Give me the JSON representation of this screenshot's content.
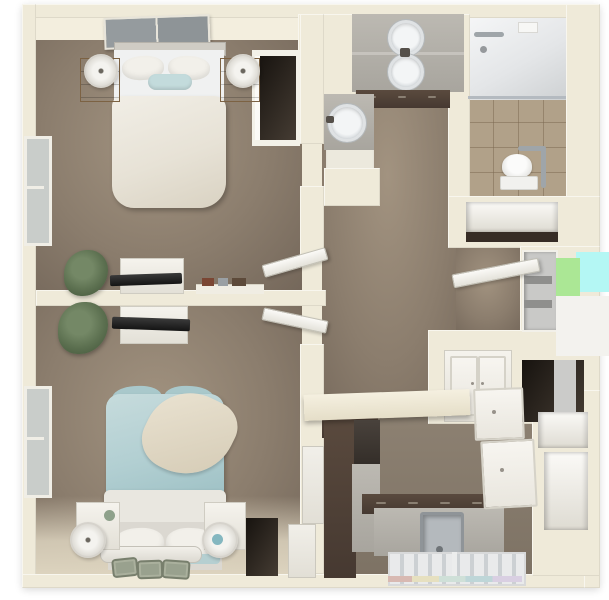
{
  "meta": {
    "description": "Top-down 3D render of a one-floor apartment floor plan",
    "render_style": "3d-dollhouse-view"
  },
  "palette": {
    "wall": "#efead9",
    "wallLight": "#f3eede",
    "carpet": "#8b7d6d",
    "carpetLight": "#a29380",
    "carpetDark": "#74675a",
    "tile": "#b1a189",
    "espresso": "#463931",
    "counter": "#a8a59e",
    "bedTeal": "#b2cfd2",
    "throwCream": "#d4cab4",
    "tvBlack": "#141414",
    "plantGreen": "#5c7050",
    "wood": "#8f7450",
    "glitchCyan": "#b4f7f4",
    "glitchGreen": "#abe795"
  },
  "rooms": [
    {
      "id": "bedroom-1",
      "label": "Bedroom 1",
      "furniture": [
        "wall-art",
        "bed-white",
        "pillows",
        "teal-accent-pillow",
        "nightstand-left",
        "table-lamp-left",
        "nightstand-right",
        "table-lamp-right",
        "window",
        "potted-plant",
        "dresser-with-tv",
        "decor-shelf",
        "closet-dark"
      ]
    },
    {
      "id": "bedroom-2",
      "label": "Bedroom 2",
      "furniture": [
        "bed-teal",
        "cream-throw-blanket",
        "white-folded-blanket",
        "pillows",
        "footboard-bench",
        "nightstand-left",
        "drum-lamp-left",
        "nightstand-right",
        "drum-lamp-right",
        "window",
        "potted-plant",
        "dresser-with-tv",
        "floor-mats"
      ]
    },
    {
      "id": "bathroom",
      "label": "Bathroom",
      "furniture": [
        "walk-in-shower",
        "shower-drain",
        "toilet",
        "grab-bar",
        "tile-floor",
        "linen-shelf"
      ]
    },
    {
      "id": "vanity-area",
      "label": "Vanity Area",
      "furniture": [
        "double-sink-vanity",
        "mirror-reflection",
        "single-sink-vanity",
        "espresso-cabinets"
      ]
    },
    {
      "id": "hallway",
      "label": "Hallway",
      "furniture": [
        "open-door-bedroom-1",
        "open-door-bedroom-2",
        "open-door-closet",
        "storage-cabinet-white",
        "shelf-niche",
        "dark-doorway"
      ]
    },
    {
      "id": "kitchen",
      "label": "Kitchen",
      "furniture": [
        "breakfast-bar",
        "espresso-tall-cabinet",
        "upper-cabinet",
        "counter-with-sink",
        "espresso-base-cabinets",
        "glass-front-appliances",
        "white-cabinet-doors",
        "pantry-shelves"
      ]
    }
  ]
}
